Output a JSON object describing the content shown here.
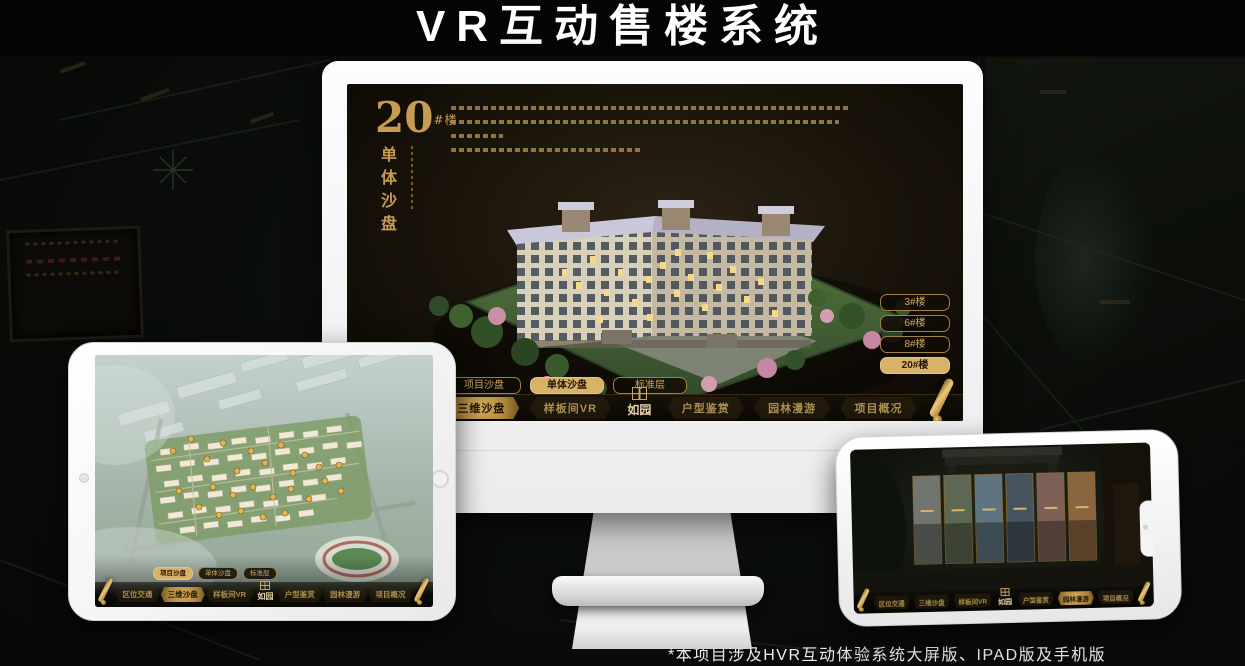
{
  "poster": {
    "title": "VR互动售楼系统",
    "footnote": "*本项目涉及HVR互动体验系统大屏版、IPAD版及手机版"
  },
  "colors": {
    "gold_accent": "#c9a45c",
    "gold_highlight": "#d9b26a",
    "screen_background": "#1c160c",
    "title_color": "#ffffff"
  },
  "app": {
    "logo": "如园"
  },
  "monitor": {
    "headline": {
      "number": "20",
      "suffix": "#楼",
      "subtitle": "单体沙盘"
    },
    "floor_buttons": [
      {
        "label": "3#楼",
        "active": false
      },
      {
        "label": "6#楼",
        "active": false
      },
      {
        "label": "8#楼",
        "active": false
      },
      {
        "label": "20#楼",
        "active": true
      }
    ],
    "sub_tabs": [
      {
        "label": "项目沙盘",
        "active": false
      },
      {
        "label": "单体沙盘",
        "active": true
      },
      {
        "label": "标准层",
        "active": false
      }
    ],
    "nav": {
      "items": [
        {
          "label": "区位交通",
          "active": false
        },
        {
          "label": "三维沙盘",
          "active": true
        },
        {
          "label": "样板间VR",
          "active": false
        },
        {
          "label": "户型鉴赏",
          "active": false
        },
        {
          "label": "园林漫游",
          "active": false
        },
        {
          "label": "项目概况",
          "active": false
        }
      ]
    }
  },
  "tablet": {
    "sub_tabs": [
      {
        "label": "项目沙盘",
        "active": true
      },
      {
        "label": "单体沙盘",
        "active": false
      },
      {
        "label": "标准层",
        "active": false
      }
    ],
    "nav": {
      "items": [
        {
          "label": "区位交通",
          "active": false
        },
        {
          "label": "三维沙盘",
          "active": true
        },
        {
          "label": "样板间VR",
          "active": false
        },
        {
          "label": "户型鉴赏",
          "active": false
        },
        {
          "label": "园林漫游",
          "active": false
        },
        {
          "label": "项目概况",
          "active": false
        }
      ]
    }
  },
  "phone": {
    "nav": {
      "items": [
        {
          "label": "区位交通",
          "active": false
        },
        {
          "label": "三维沙盘",
          "active": false
        },
        {
          "label": "样板间VR",
          "active": false
        },
        {
          "label": "户型鉴赏",
          "active": false
        },
        {
          "label": "园林漫游",
          "active": true
        },
        {
          "label": "项目概况",
          "active": false
        }
      ]
    }
  }
}
